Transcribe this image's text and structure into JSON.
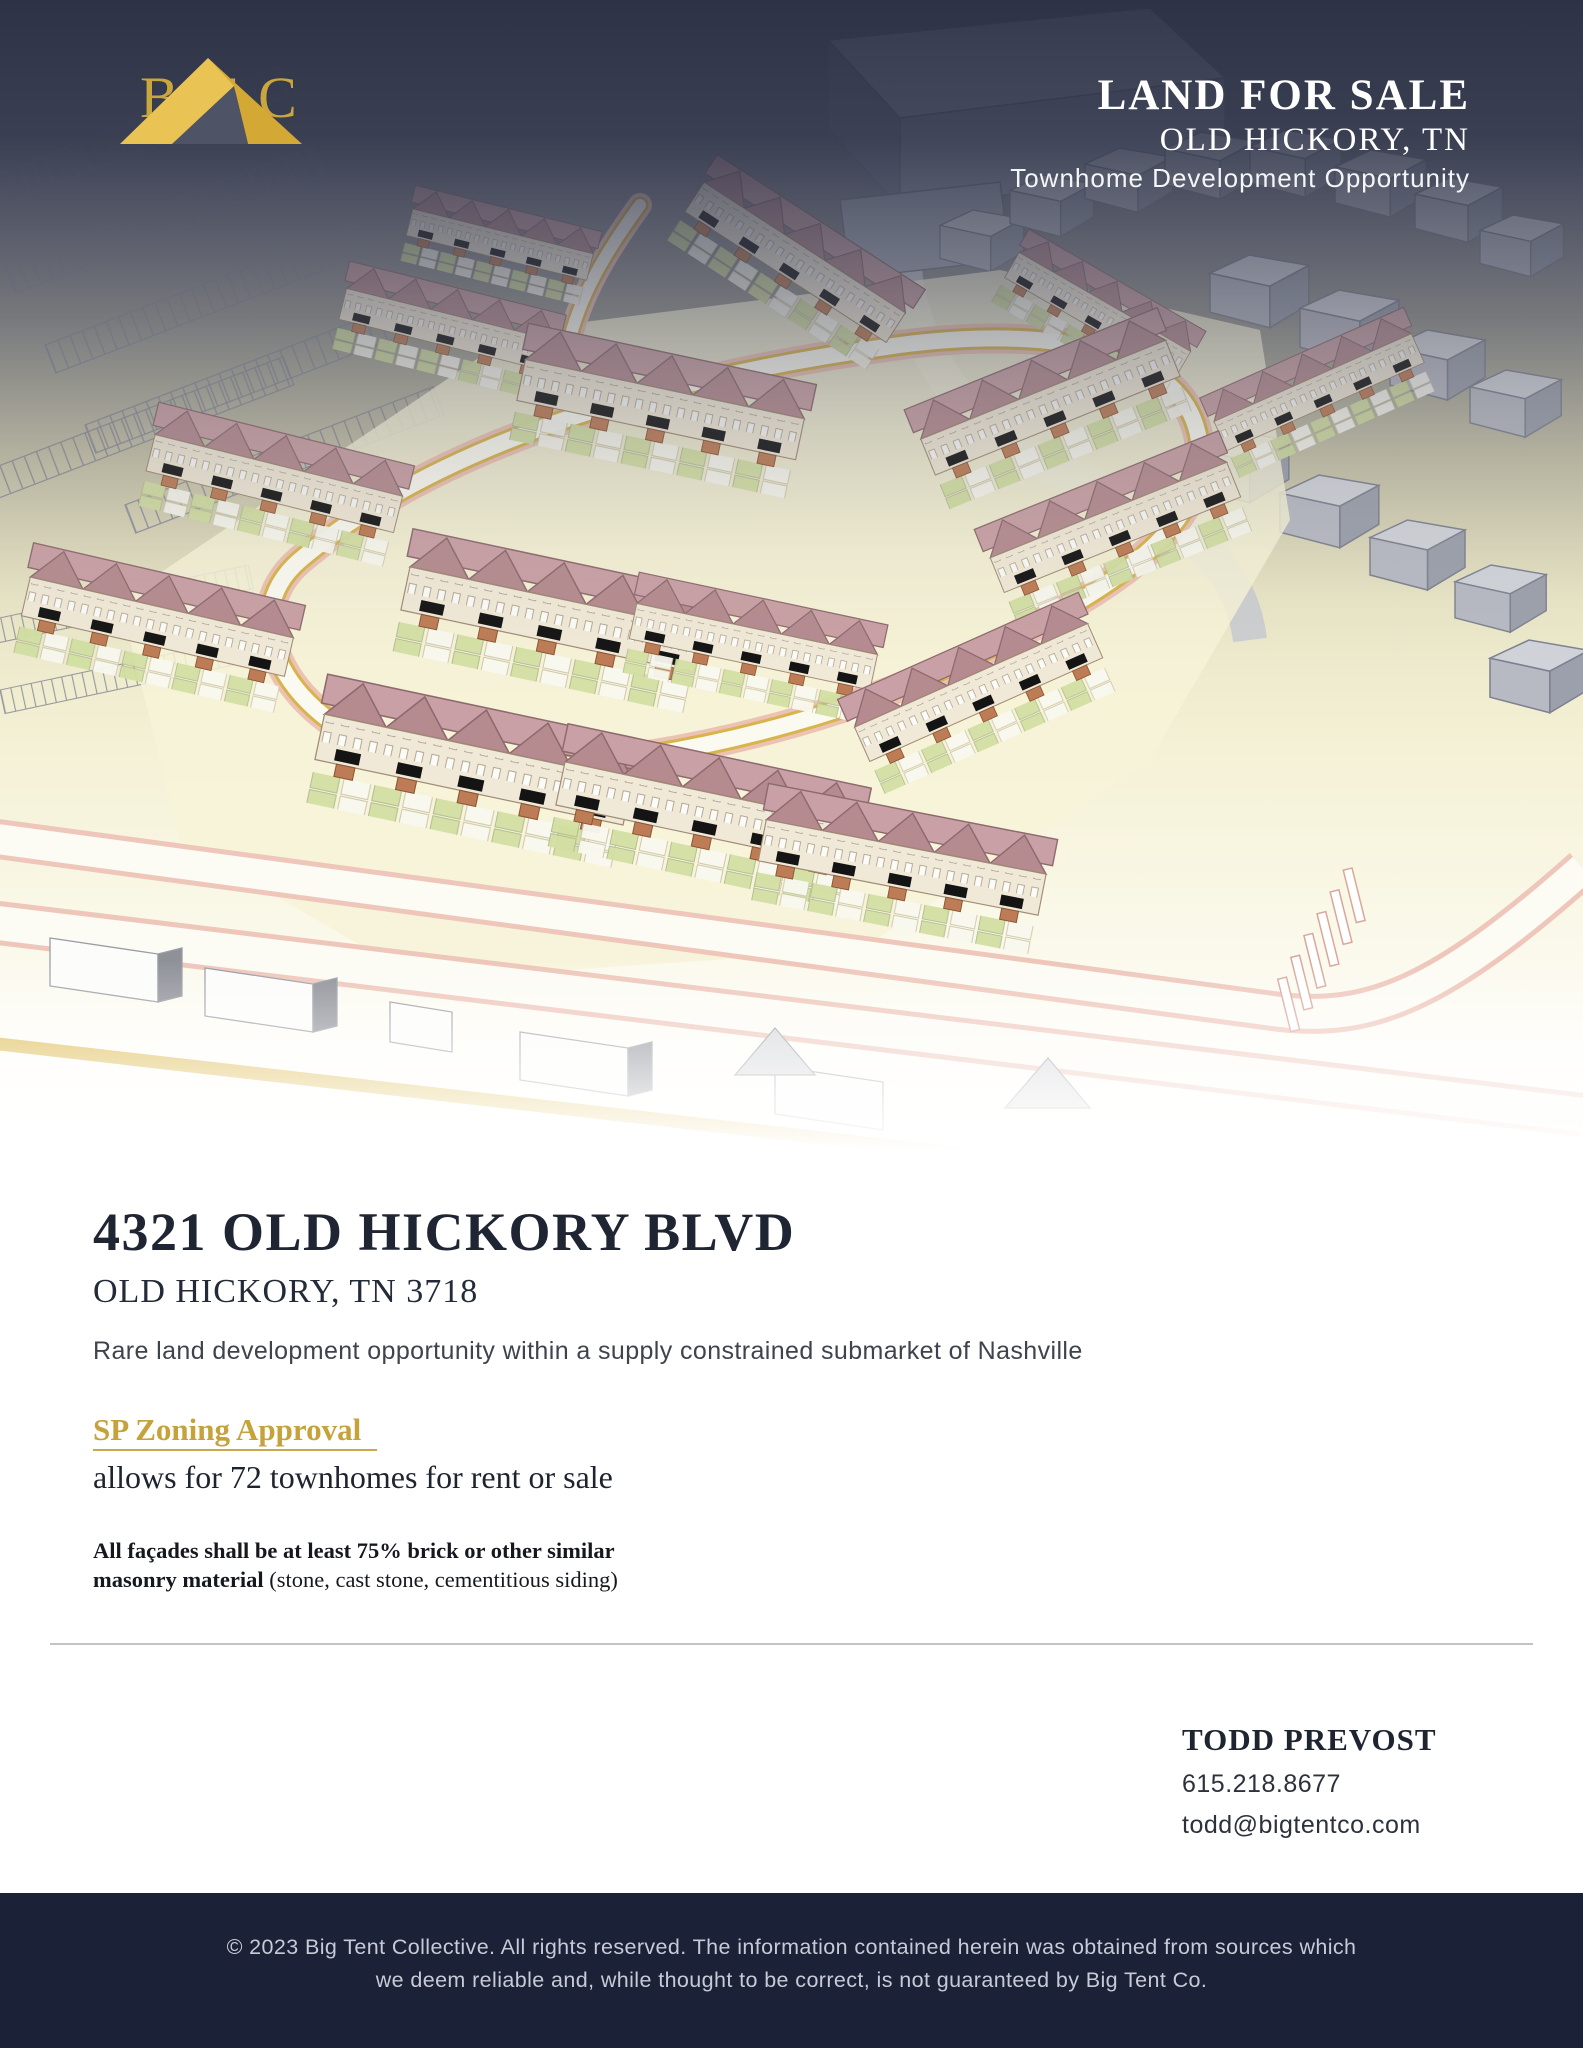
{
  "brand": {
    "logo_text": "BTC"
  },
  "hero": {
    "title": "LAND FOR SALE",
    "location": "OLD HICKORY, TN",
    "subtitle": "Townhome Development Opportunity"
  },
  "property": {
    "address": "4321 OLD HICKORY BLVD",
    "city_state_zip": "OLD HICKORY, TN 3718",
    "description": "Rare land development opportunity within a supply constrained submarket of Nashville",
    "zoning_link_label": "SP Zoning Approval",
    "zoning_detail": "allows for 72 townhomes for rent or sale",
    "facade_requirement_bold": "All façades shall be at least 75% brick or other similar masonry material",
    "facade_requirement_note": "(stone, cast stone, cementitious siding)"
  },
  "contact": {
    "name": "TODD PREVOST",
    "phone": "615.218.8677",
    "email": "todd@bigtentco.com"
  },
  "footer": {
    "line1": "© 2023 Big Tent Collective. All rights reserved. The information contained herein was obtained from sources which",
    "line2": "we deem reliable and, while thought to be correct, is not guaranteed by Big Tent Co."
  },
  "colors": {
    "accent_gold": "#C8A43C",
    "heading_navy": "#202736",
    "footer_bg": "#1B2136",
    "roof_rose": "#B58B90",
    "site_cream": "#F7F3D8"
  }
}
